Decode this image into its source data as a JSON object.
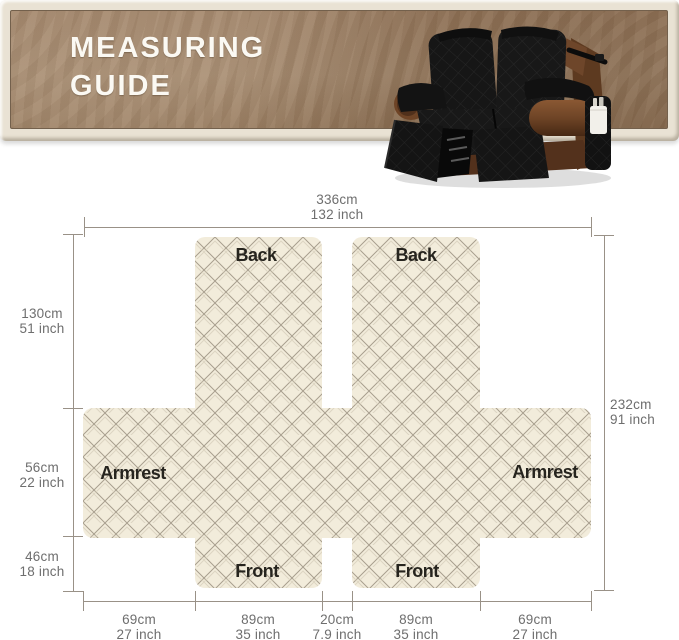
{
  "banner": {
    "title_line1": "MEASURING",
    "title_line2": "GUIDE"
  },
  "product_photo": {
    "description": "black quilted recliner loveseat cover on brown leather recliner",
    "colors": {
      "cover": "#141414",
      "leather": "#6e4426",
      "pocket": "#f2f0ea"
    }
  },
  "diagram": {
    "labels": {
      "back_left": "Back",
      "back_right": "Back",
      "armrest_left": "Armrest",
      "armrest_right": "Armrest",
      "front_left": "Front",
      "front_right": "Front"
    },
    "dimensions": {
      "top": {
        "cm": "336cm",
        "inch": "132 inch"
      },
      "right": {
        "cm": "232cm",
        "inch": "91 inch"
      },
      "left": [
        {
          "cm": "130cm",
          "inch": "51 inch"
        },
        {
          "cm": "56cm",
          "inch": "22 inch"
        },
        {
          "cm": "46cm",
          "inch": "18 inch"
        }
      ],
      "bottom": [
        {
          "cm": "69cm",
          "inch": "27 inch"
        },
        {
          "cm": "89cm",
          "inch": "35 inch"
        },
        {
          "cm": "20cm",
          "inch": "7.9 inch"
        },
        {
          "cm": "89cm",
          "inch": "35 inch"
        },
        {
          "cm": "69cm",
          "inch": "27 inch"
        }
      ]
    },
    "colors": {
      "fabric": "#f2ecdb",
      "lattice": "#a89f8e",
      "dimension_line": "#999187",
      "dimension_text": "#6e6e6e",
      "label_text": "#26241e",
      "banner_brown": "#9a7b5f",
      "banner_frame": "#e9e2d4"
    }
  }
}
